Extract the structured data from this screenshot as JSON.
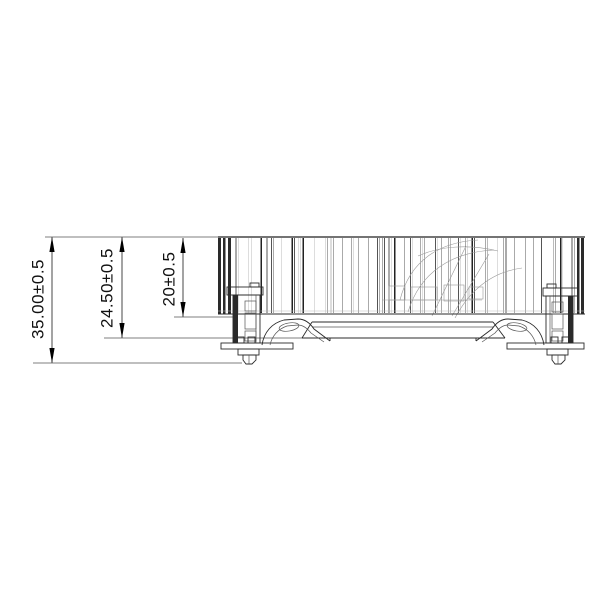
{
  "drawing": {
    "kind": "heatsink-side-elevation",
    "dims": {
      "total": {
        "label": "35.00±0.5"
      },
      "mount": {
        "label": "24.50±0.5"
      },
      "body": {
        "label": "20±0.5"
      }
    },
    "colors": {
      "ink": "#1a1a1a",
      "thin_line": "#555555",
      "faint_line": "#999999",
      "background": "#ffffff"
    }
  }
}
